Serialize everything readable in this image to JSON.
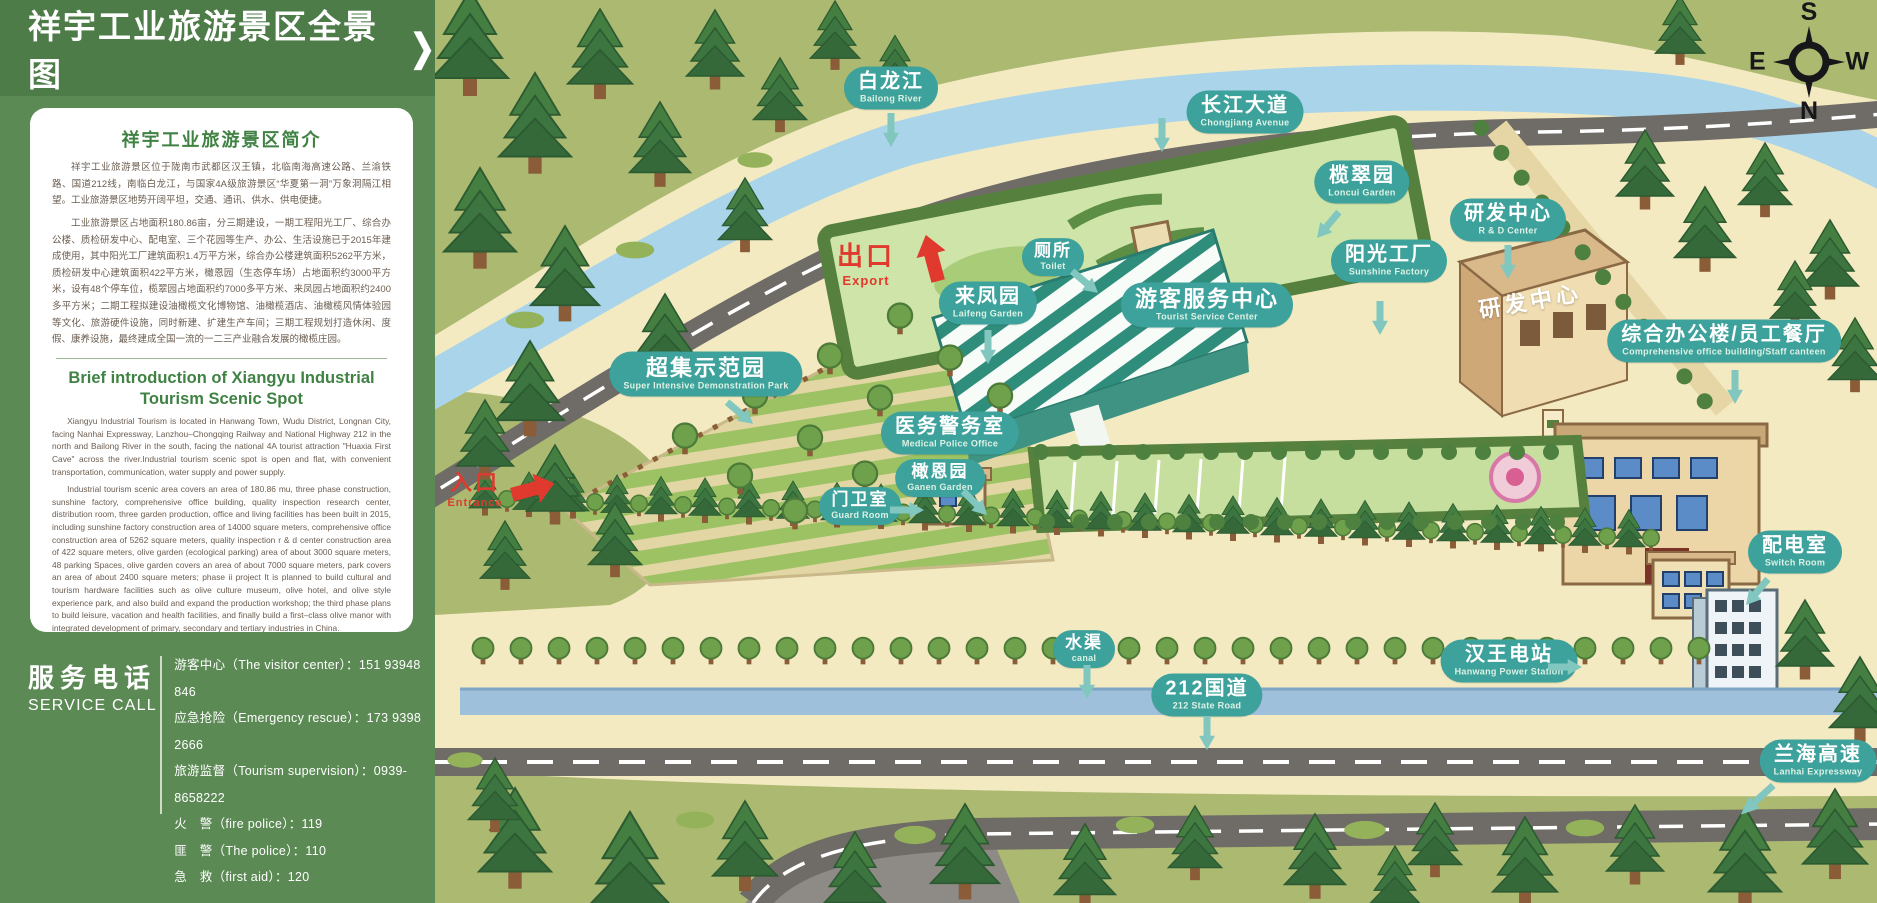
{
  "panel": {
    "title": "祥宇工业旅游景区全景图",
    "intro_zh": {
      "heading": "祥宇工业旅游景区简介",
      "p1": "祥宇工业旅游景区位于陇南市武都区汉王镇，北临南海高速公路、兰渝铁路、国道212线，南临白龙江，与国家4A级旅游景区“华夏第一洞”万象洞隔江相望。工业旅游景区地势开阔平坦，交通、通讯、供水、供电便捷。",
      "p2": "工业旅游景区占地面积180.86亩，分三期建设，一期工程阳光工厂、综合办公楼、质检研发中心、配电室、三个花园等生产、办公、生活设施已于2015年建成使用，其中阳光工厂建筑面积1.4万平方米，综合办公楼建筑面积5262平方米，质检研发中心建筑面积422平方米，橄恩园（生态停车场）占地面积约3000平方米，设有48个停车位，榄翠园占地面积约7000多平方米、来凤园占地面积约2400多平方米；二期工程拟建设油橄榄文化博物馆、油橄榄酒店、油橄榄风情体验园等文化、旅游硬件设施，同时新建、扩建生产车间；三期工程规划打造休闲、度假、康养设施，最终建成全国一流的一二三产业融合发展的橄榄庄园。"
    },
    "intro_en": {
      "heading": "Brief introduction of Xiangyu Industrial Tourism Scenic Spot",
      "p1": "Xiangyu Industrial Tourism is located in Hanwang Town, Wudu District, Longnan City, facing Nanhai Expressway, Lanzhou–Chongqing Railway and National Highway 212 in the north and Bailong River in the south, facing the national 4A tourist attraction \"Huaxia First Cave\" across the river.Industrial tourism scenic spot is open and flat, with convenient transportation, communication, water supply and power supply.",
      "p2": "Industrial tourism scenic area covers an area of 180.86 mu, three phase construction, sunshine factory, comprehensive office building, quality inspection research center, distribution room, three garden production, office and living facilities has been built in 2015, including sunshine factory construction area of 14000 square meters, comprehensive office construction area of 5262 square meters, quality inspection r & d center construction area of 422 square meters, olive garden (ecological parking) area of about 3000 square meters, 48 parking Spaces, olive garden covers an area of about 7000 square meters, park covers an area of about 2400 square meters; phase ii project It is planned to build cultural and tourism hardware facilities such as olive culture museum, olive hotel, and olive style experience park, and also build and expand the production workshop; the third phase plans to build leisure, vacation and health facilities, and finally build a first–class olive manor with integrated development of primary, secondary and tertiary industries in China."
    },
    "service": {
      "title_zh": "服务电话",
      "title_en": "SERVICE CALL",
      "entries": [
        "游客中心（The visitor center）：151 93948 846",
        "应急抢险（Emergency rescue）：173 9398 2666",
        "旅游监督（Tourism supervision）：0939-8658222",
        "火　警（fire police）：119",
        "匪　警（The police）：110",
        "急　救（first aid）：120"
      ]
    }
  },
  "map": {
    "labels": [
      {
        "zh": "白龙江",
        "en": "Bailong River"
      },
      {
        "zh": "长江大道",
        "en": "Chongjiang Avenue"
      },
      {
        "zh": "榄翠园",
        "en": "Loncui Garden"
      },
      {
        "zh": "研发中心",
        "en": "R & D Center"
      },
      {
        "zh": "厕所",
        "en": "Toilet"
      },
      {
        "zh": "来凤园",
        "en": "Laifeng Garden"
      },
      {
        "zh": "游客服务中心",
        "en": "Tourist Service Center"
      },
      {
        "zh": "阳光工厂",
        "en": "Sunshine Factory"
      },
      {
        "zh": "综合办公楼/员工餐厅",
        "en": "Comprehensive office building/Staff canteen"
      },
      {
        "zh": "超集示范园",
        "en": "Super Intensive Demonstration Park"
      },
      {
        "zh": "医务警务室",
        "en": "Medical Police Office"
      },
      {
        "zh": "门卫室",
        "en": "Guard Room"
      },
      {
        "zh": "橄恩园",
        "en": "Ganen Garden"
      },
      {
        "zh": "配电室",
        "en": "Switch Room"
      },
      {
        "zh": "水渠",
        "en": "canal"
      },
      {
        "zh": "212国道",
        "en": "212 State Road"
      },
      {
        "zh": "汉王电站",
        "en": "Hanwang Power Station"
      },
      {
        "zh": "兰海高速",
        "en": "Lanhai Expressway"
      }
    ],
    "exit": {
      "zh": "出口",
      "en": "Export"
    },
    "entrance": {
      "zh": "入口",
      "en": "Entrance"
    },
    "building_label": "研发中心",
    "compass": {
      "top": "S",
      "left": "E",
      "right": "W",
      "bottom": "N"
    }
  },
  "colors": {
    "badge_teal": "#3da19c",
    "marker_red": "#e03a2e",
    "panel_green": "#5c8a55",
    "title_band_green": "#4d7c49",
    "heading_green": "#3f8243",
    "grass": "#abb971",
    "river_blue": "#a9d4ea"
  }
}
